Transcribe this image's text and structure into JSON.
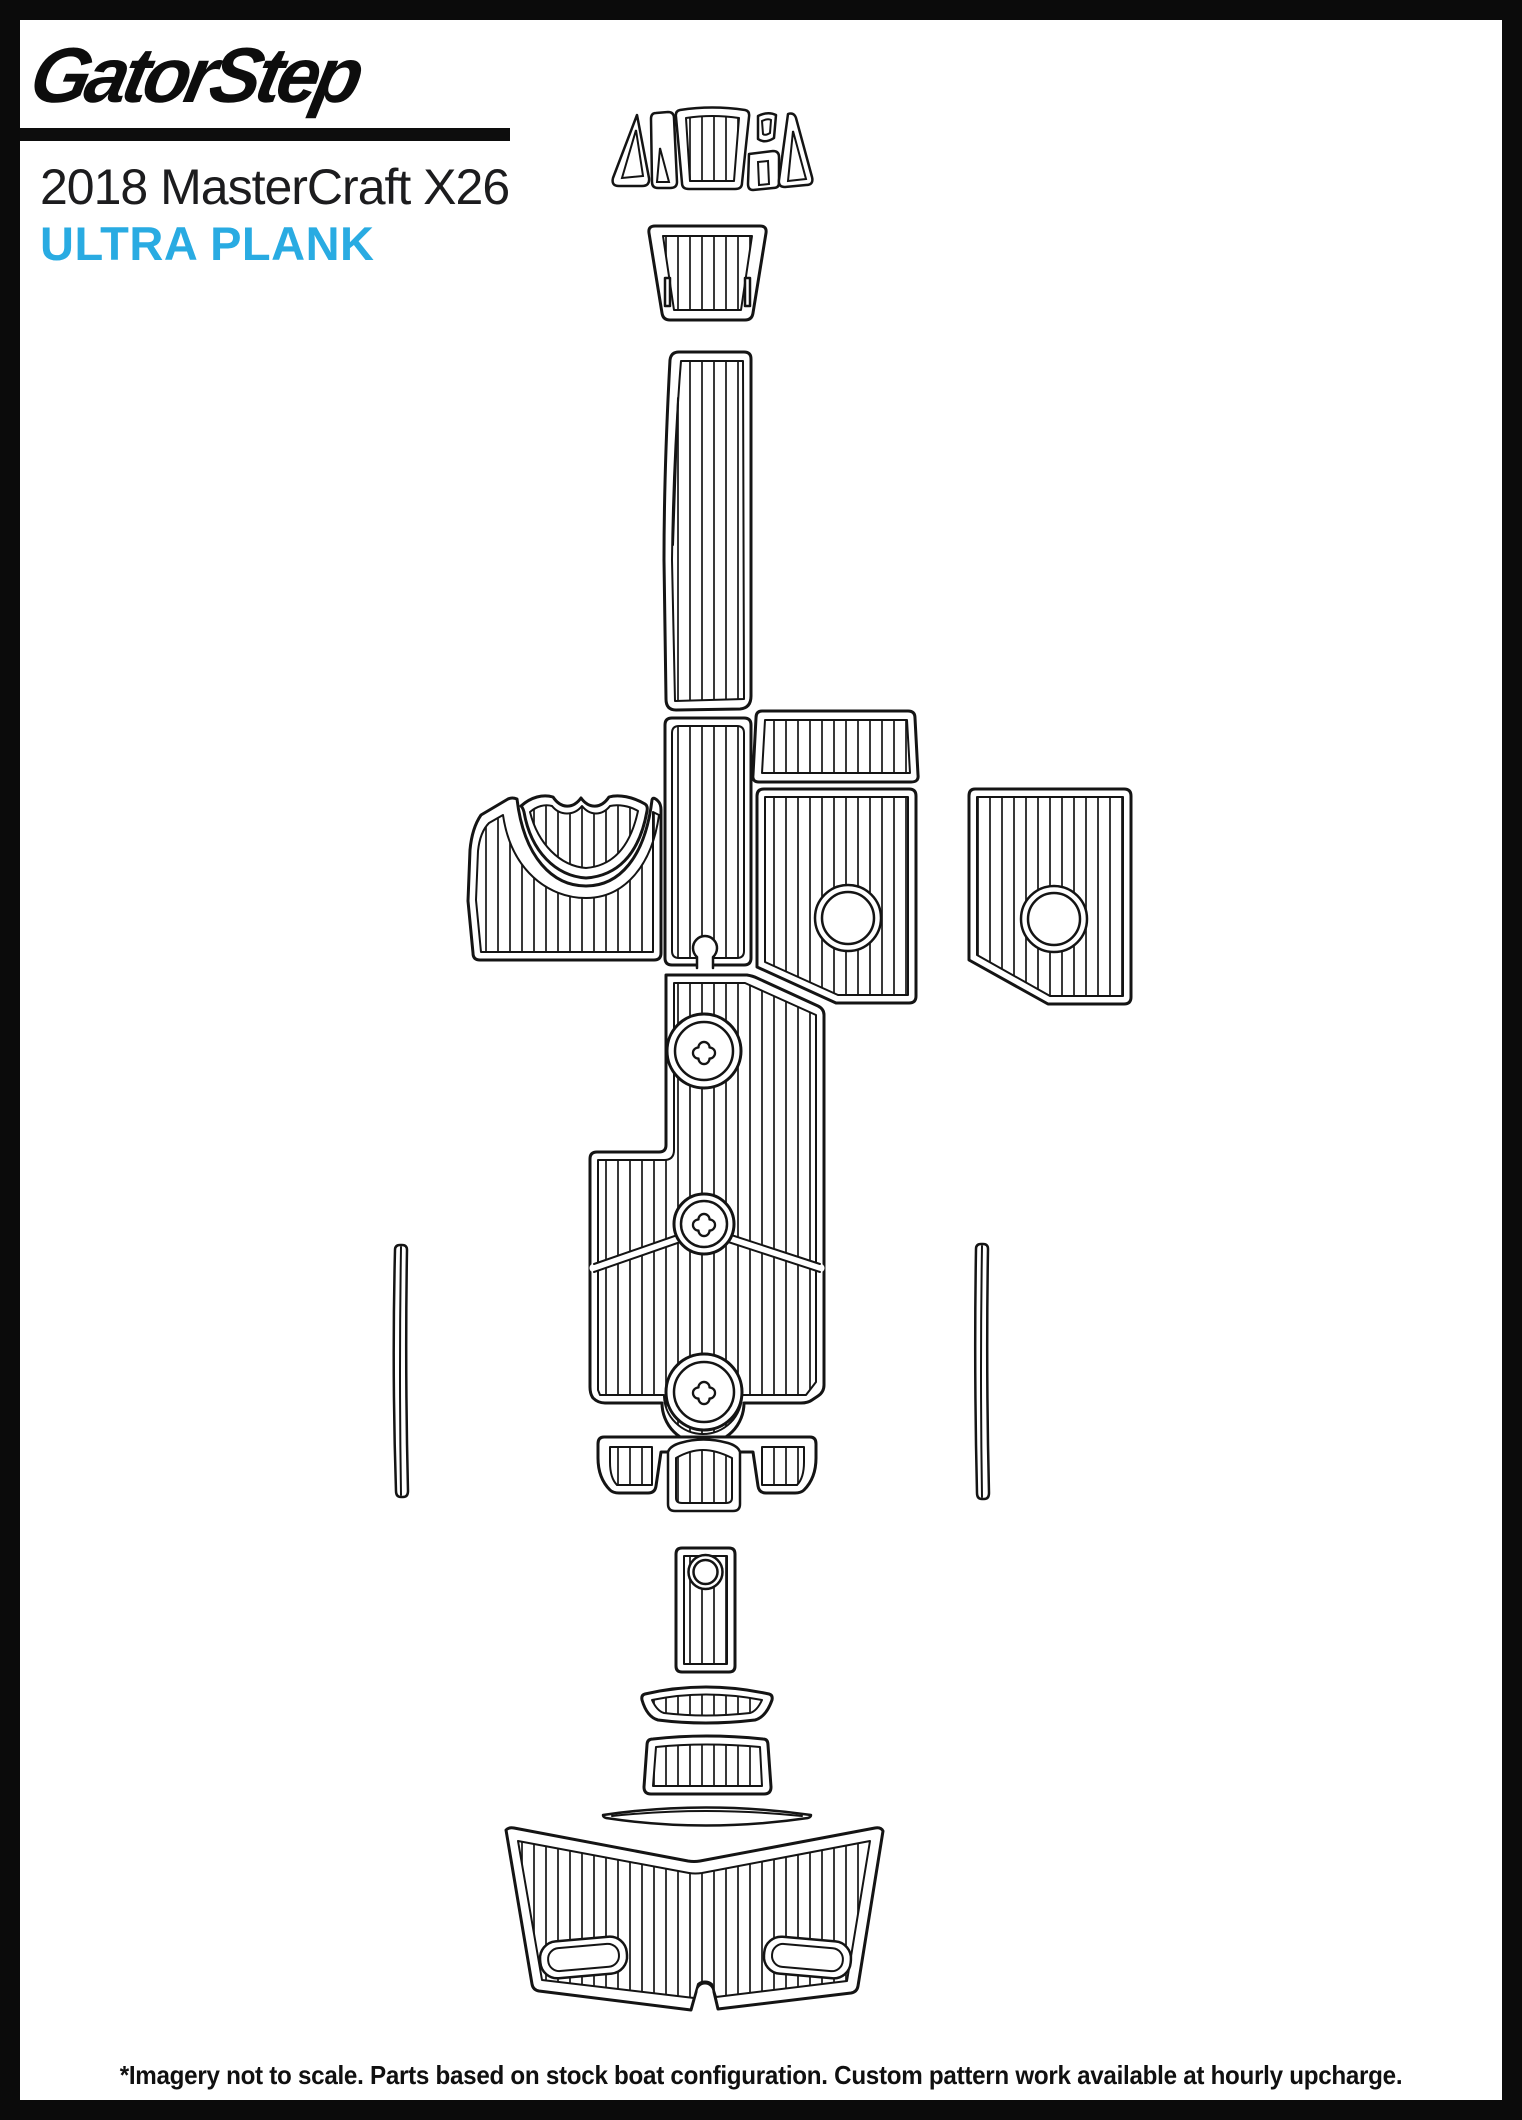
{
  "page": {
    "brand": "GatorStep",
    "title": "2018 MasterCraft X26",
    "product_line": "ULTRA PLANK",
    "disclaimer": "*Imagery not to scale. Parts based on stock boat configuration. Custom pattern work available at hourly upcharge.",
    "colors": {
      "accent_cyan": "#29ABE2",
      "ink_black": "#0D0D0D",
      "line_art": "#141414",
      "background": "#FFFFFF"
    }
  },
  "diagram": {
    "kind": "boat deck traction pad template line art",
    "parts": [
      "bow-filler-set",
      "bow-step-pad",
      "bow-walkway-runner",
      "mid-walkway-runner",
      "port-bow-seating-pad",
      "bow-seat-crescent-pad",
      "starboard-upper-deck-pad",
      "starboard-observer-pad",
      "starboard-side-deck-pad",
      "main-cockpit-floor",
      "pylon-ring-pad-top",
      "pylon-ring-pad-middle",
      "pylon-ring-pad-bottom",
      "side-trim-strip-left",
      "side-trim-strip-right",
      "rear-bench-pad",
      "transom-step-pad",
      "transom-arc-pad",
      "transom-wedge-pad",
      "transom-trim-strip",
      "swim-platform-pad"
    ]
  }
}
